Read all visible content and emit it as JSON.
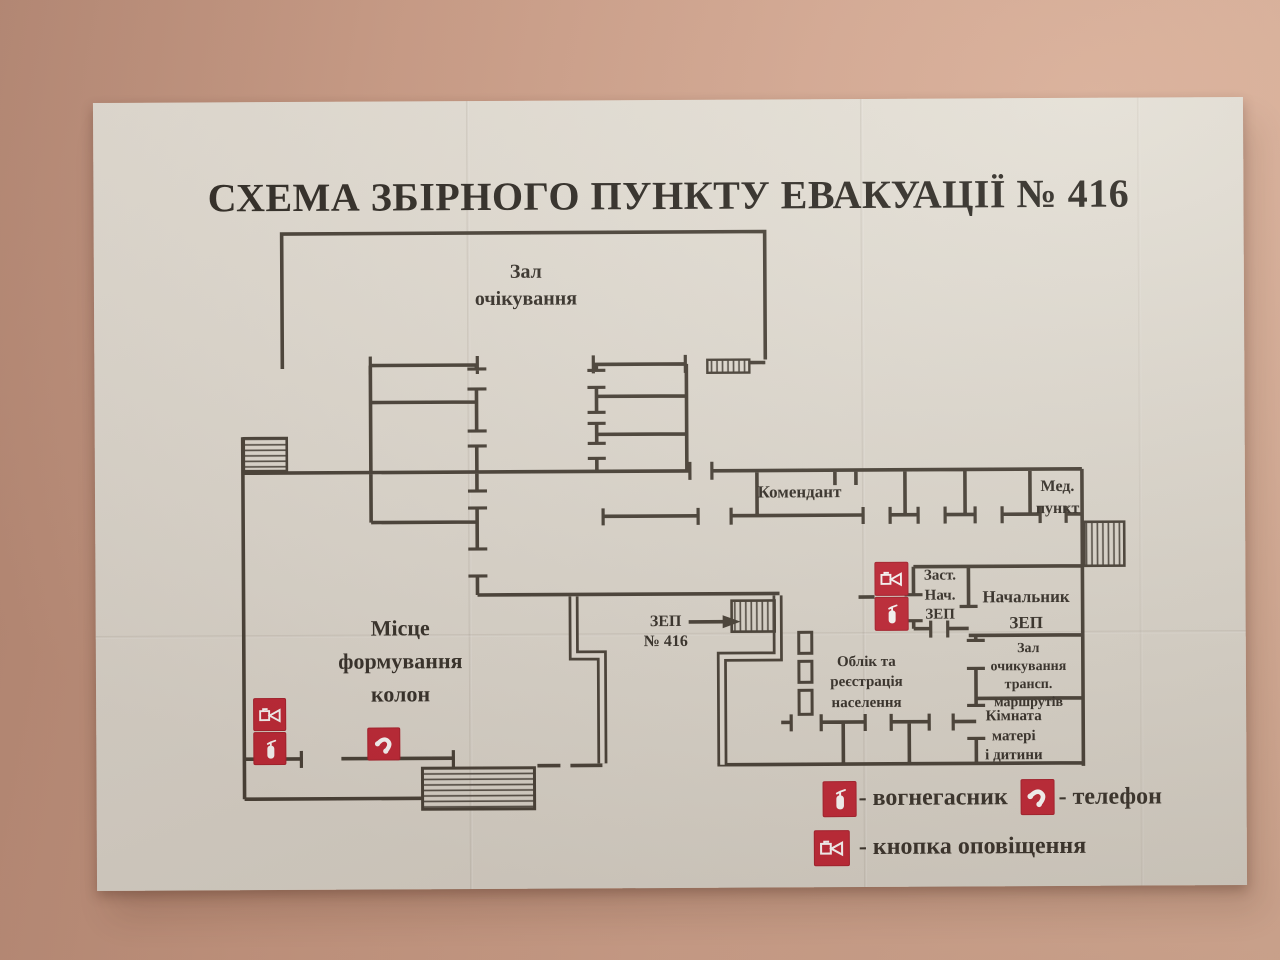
{
  "poster": {
    "title": "СХЕМА ЗБІРНОГО ПУНКТУ ЕВАКУАЦІЇ № 416",
    "rooms": {
      "waiting_hall": "Зал\nочікування",
      "commandant": "Комендант",
      "med_point": "Мед.\nпункт",
      "deputy_head_zep": "Заст.\nНач.\nЗЕП",
      "head_zep": "Начальник\nЗЕП",
      "transport_waiting_hall": "Зал\nочикування\nтрансп.\nмаршрутів",
      "mother_child_room": "Кімната\nматері\nі дитини",
      "registration": "Облік та\nреєстрація\nнаселення",
      "column_forming_area": "Місце\nформування\nколон",
      "zep_entrance": "ЗЕП\n№ 416"
    },
    "legend": {
      "extinguisher": "- вогнегасник",
      "phone": "- телефон",
      "alert_button": "- кнопка оповіщення"
    },
    "colors": {
      "icon_red": "#c22838",
      "wall_line": "#474239",
      "paper": "#e2dfd6",
      "wall_pink": "#cfa28c"
    }
  }
}
